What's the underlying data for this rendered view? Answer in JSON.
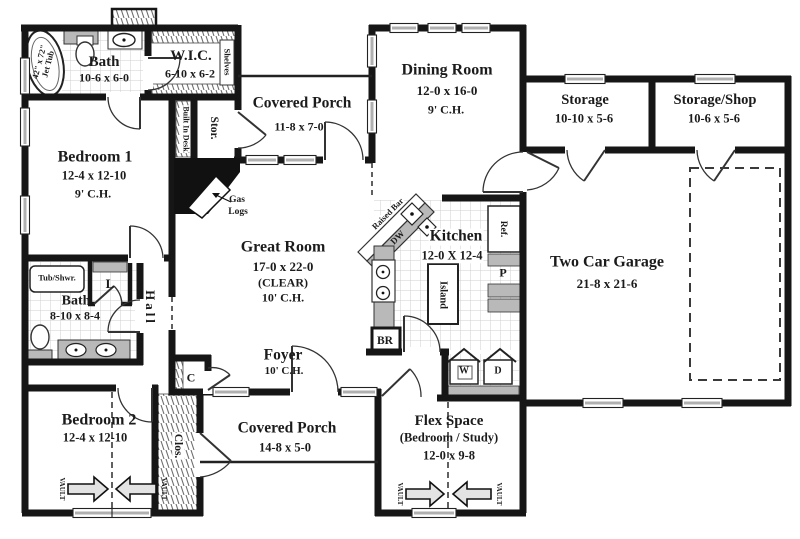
{
  "plan": {
    "rooms": {
      "bath1": {
        "name": "Bath",
        "dims": "10-6 x 6-0"
      },
      "wic": {
        "name": "W.I.C.",
        "dims": "6-10 x 6-2"
      },
      "covered_porch_rear": {
        "name": "Covered Porch",
        "dims": "11-8 x 7-0"
      },
      "dining": {
        "name": "Dining Room",
        "dims": "12-0 x 16-0",
        "ceiling": "9' C.H."
      },
      "storage": {
        "name": "Storage",
        "dims": "10-10 x 5-6"
      },
      "storage_shop": {
        "name": "Storage/Shop",
        "dims": "10-6 x 5-6"
      },
      "bedroom1": {
        "name": "Bedroom 1",
        "dims": "12-4 x 12-10",
        "ceiling": "9' C.H."
      },
      "great_room": {
        "name": "Great Room",
        "dims": "17-0 x 22-0",
        "note": "(CLEAR)",
        "ceiling": "10' C.H."
      },
      "kitchen": {
        "name": "Kitchen",
        "dims": "12-0 X 12-4"
      },
      "garage": {
        "name": "Two Car Garage",
        "dims": "21-8 x 21-6"
      },
      "bath2": {
        "name": "Bath",
        "dims": "8-10 x 8-4"
      },
      "hall": {
        "name": "Hall"
      },
      "foyer": {
        "name": "Foyer",
        "ceiling": "10' C.H."
      },
      "bedroom2": {
        "name": "Bedroom 2",
        "dims": "12-4 x 12-10"
      },
      "covered_porch_front": {
        "name": "Covered Porch",
        "dims": "14-8 x 5-0"
      },
      "flex": {
        "name": "Flex Space",
        "sub": "(Bedroom / Study)",
        "dims": "12-0 x 9-8"
      }
    },
    "fixtures": {
      "jet_tub_line1": "42\" x 72\"",
      "jet_tub_line2": "Jet Tub",
      "shelves": "Shelves",
      "built_in_desk": "Built In Desk",
      "stor_closet": "Stor.",
      "gas_logs_line1": "Gas",
      "gas_logs_line2": "Logs",
      "tub_shower": "Tub/Shwr.",
      "linen": "L",
      "raised_bar": "Raised Bar",
      "dishwasher": "DW",
      "refrigerator": "Ref.",
      "island": "Island",
      "pantry": "P",
      "broom_closet": "BR",
      "coat_closet": "C",
      "closet": "Clos.",
      "washer": "W",
      "dryer": "D",
      "vault": "VAULT"
    },
    "colors": {
      "wall": "#161616",
      "counter": "#b9b9b9",
      "tile_line": "#cfcfcf"
    }
  }
}
